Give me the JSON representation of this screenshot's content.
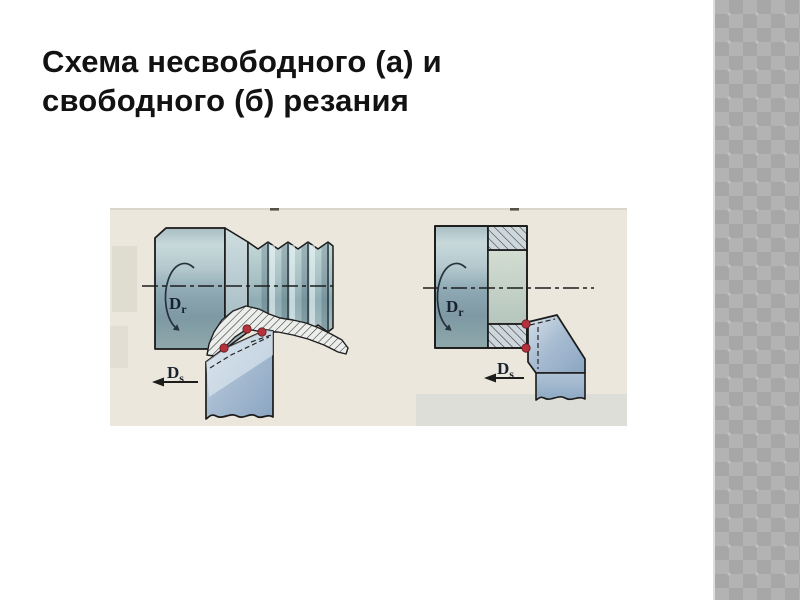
{
  "slide": {
    "title_lines": [
      "Схема несвободного (а) и",
      "свободного (б) резания"
    ],
    "background_color": "#ffffff",
    "title_color": "#121212"
  },
  "figure": {
    "paper_color": "#ebe7dc",
    "outline_color": "#1a1a1a",
    "contact_point_color": "#b5323c",
    "metal_light": "#c8d9db",
    "metal_dark": "#7e99a3",
    "tool_light": "#d6e1e9",
    "tool_dark": "#8aa5c2",
    "diagram_a": {
      "rotation_label": {
        "main": "D",
        "sub": "r"
      },
      "feed_label": {
        "main": "D",
        "sub": "s"
      }
    },
    "diagram_b": {
      "rotation_label": {
        "main": "D",
        "sub": "r"
      },
      "feed_label": {
        "main": "D",
        "sub": "s"
      }
    }
  },
  "sidebar": {
    "pattern_color_dark": "#a7a7a7",
    "pattern_color_light": "#b3b3b3"
  }
}
